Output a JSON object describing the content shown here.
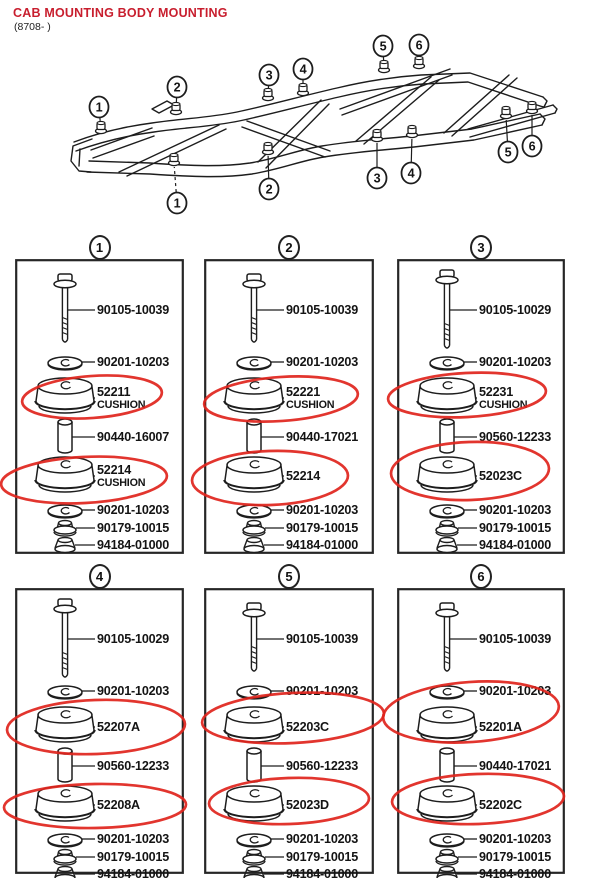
{
  "header": {
    "title": "CAB MOUNTING BODY MOUNTING",
    "date_range": "(8708- )"
  },
  "colors": {
    "ink": "#1d1d1d",
    "title_red": "#c81e2e",
    "marker_red": "#e0241c"
  },
  "chassis": {
    "callouts_top": [
      "1",
      "2",
      "3",
      "4",
      "5",
      "6"
    ],
    "callouts_bottom": [
      "1",
      "2",
      "3",
      "4",
      "5",
      "6"
    ]
  },
  "panels": [
    {
      "callout": "1",
      "parts": [
        {
          "type": "bolt",
          "label": "90105-10039",
          "circled": false
        },
        {
          "type": "washer",
          "label": "90201-10203",
          "circled": false
        },
        {
          "type": "cushion",
          "label": "52211",
          "sublabel": "CUSHION",
          "circled": true
        },
        {
          "type": "spacer",
          "label": "90440-16007",
          "circled": false
        },
        {
          "type": "cushion",
          "label": "52214",
          "sublabel": "CUSHION",
          "circled": true
        },
        {
          "type": "washer",
          "label": "90201-10203",
          "circled": false
        },
        {
          "type": "nut",
          "label": "90179-10015",
          "circled": false
        },
        {
          "type": "capnut",
          "label": "94184-01000",
          "circled": false
        }
      ]
    },
    {
      "callout": "2",
      "parts": [
        {
          "type": "bolt",
          "label": "90105-10039",
          "circled": false
        },
        {
          "type": "washer",
          "label": "90201-10203",
          "circled": false
        },
        {
          "type": "cushion",
          "label": "52221",
          "sublabel": "CUSHION",
          "circled": true
        },
        {
          "type": "spacer",
          "label": "90440-17021",
          "circled": false
        },
        {
          "type": "cushion",
          "label": "52214",
          "circled": true
        },
        {
          "type": "washer",
          "label": "90201-10203",
          "circled": false
        },
        {
          "type": "nut",
          "label": "90179-10015",
          "circled": false
        },
        {
          "type": "capnut",
          "label": "94184-01000",
          "circled": false
        }
      ]
    },
    {
      "callout": "3",
      "parts": [
        {
          "type": "bolt",
          "label": "90105-10029",
          "circled": false
        },
        {
          "type": "washer",
          "label": "90201-10203",
          "circled": false
        },
        {
          "type": "cushion",
          "label": "52231",
          "sublabel": "CUSHION",
          "circled": true
        },
        {
          "type": "spacer",
          "label": "90560-12233",
          "circled": false
        },
        {
          "type": "cushion",
          "label": "52023C",
          "circled": true
        },
        {
          "type": "washer",
          "label": "90201-10203",
          "circled": false
        },
        {
          "type": "nut",
          "label": "90179-10015",
          "circled": false
        },
        {
          "type": "capnut",
          "label": "94184-01000",
          "circled": false
        }
      ]
    },
    {
      "callout": "4",
      "parts": [
        {
          "type": "bolt",
          "label": "90105-10029",
          "circled": false
        },
        {
          "type": "washer",
          "label": "90201-10203",
          "circled": false
        },
        {
          "type": "cushion",
          "label": "52207A",
          "circled": true
        },
        {
          "type": "spacer",
          "label": "90560-12233",
          "circled": false
        },
        {
          "type": "cushion",
          "label": "52208A",
          "circled": true
        },
        {
          "type": "washer",
          "label": "90201-10203",
          "circled": false
        },
        {
          "type": "nut",
          "label": "90179-10015",
          "circled": false
        },
        {
          "type": "capnut",
          "label": "94184-01000",
          "circled": false
        }
      ]
    },
    {
      "callout": "5",
      "parts": [
        {
          "type": "bolt",
          "label": "90105-10039",
          "circled": false
        },
        {
          "type": "washer",
          "label": "90201-10203",
          "circled": false
        },
        {
          "type": "cushion",
          "label": "52203C",
          "circled": true
        },
        {
          "type": "spacer",
          "label": "90560-12233",
          "circled": false
        },
        {
          "type": "cushion",
          "label": "52023D",
          "circled": true
        },
        {
          "type": "washer",
          "label": "90201-10203",
          "circled": false
        },
        {
          "type": "nut",
          "label": "90179-10015",
          "circled": false
        },
        {
          "type": "capnut",
          "label": "94184-01000",
          "circled": false
        }
      ]
    },
    {
      "callout": "6",
      "parts": [
        {
          "type": "bolt",
          "label": "90105-10039",
          "circled": false
        },
        {
          "type": "washer",
          "label": "90201-10203",
          "circled": false
        },
        {
          "type": "cushion",
          "label": "52201A",
          "circled": true
        },
        {
          "type": "spacer",
          "label": "90440-17021",
          "circled": false
        },
        {
          "type": "cushion",
          "label": "52202C",
          "circled": true
        },
        {
          "type": "washer",
          "label": "90201-10203",
          "circled": false
        },
        {
          "type": "nut",
          "label": "90179-10015",
          "circled": false
        },
        {
          "type": "capnut",
          "label": "94184-01000",
          "circled": false
        }
      ]
    }
  ]
}
